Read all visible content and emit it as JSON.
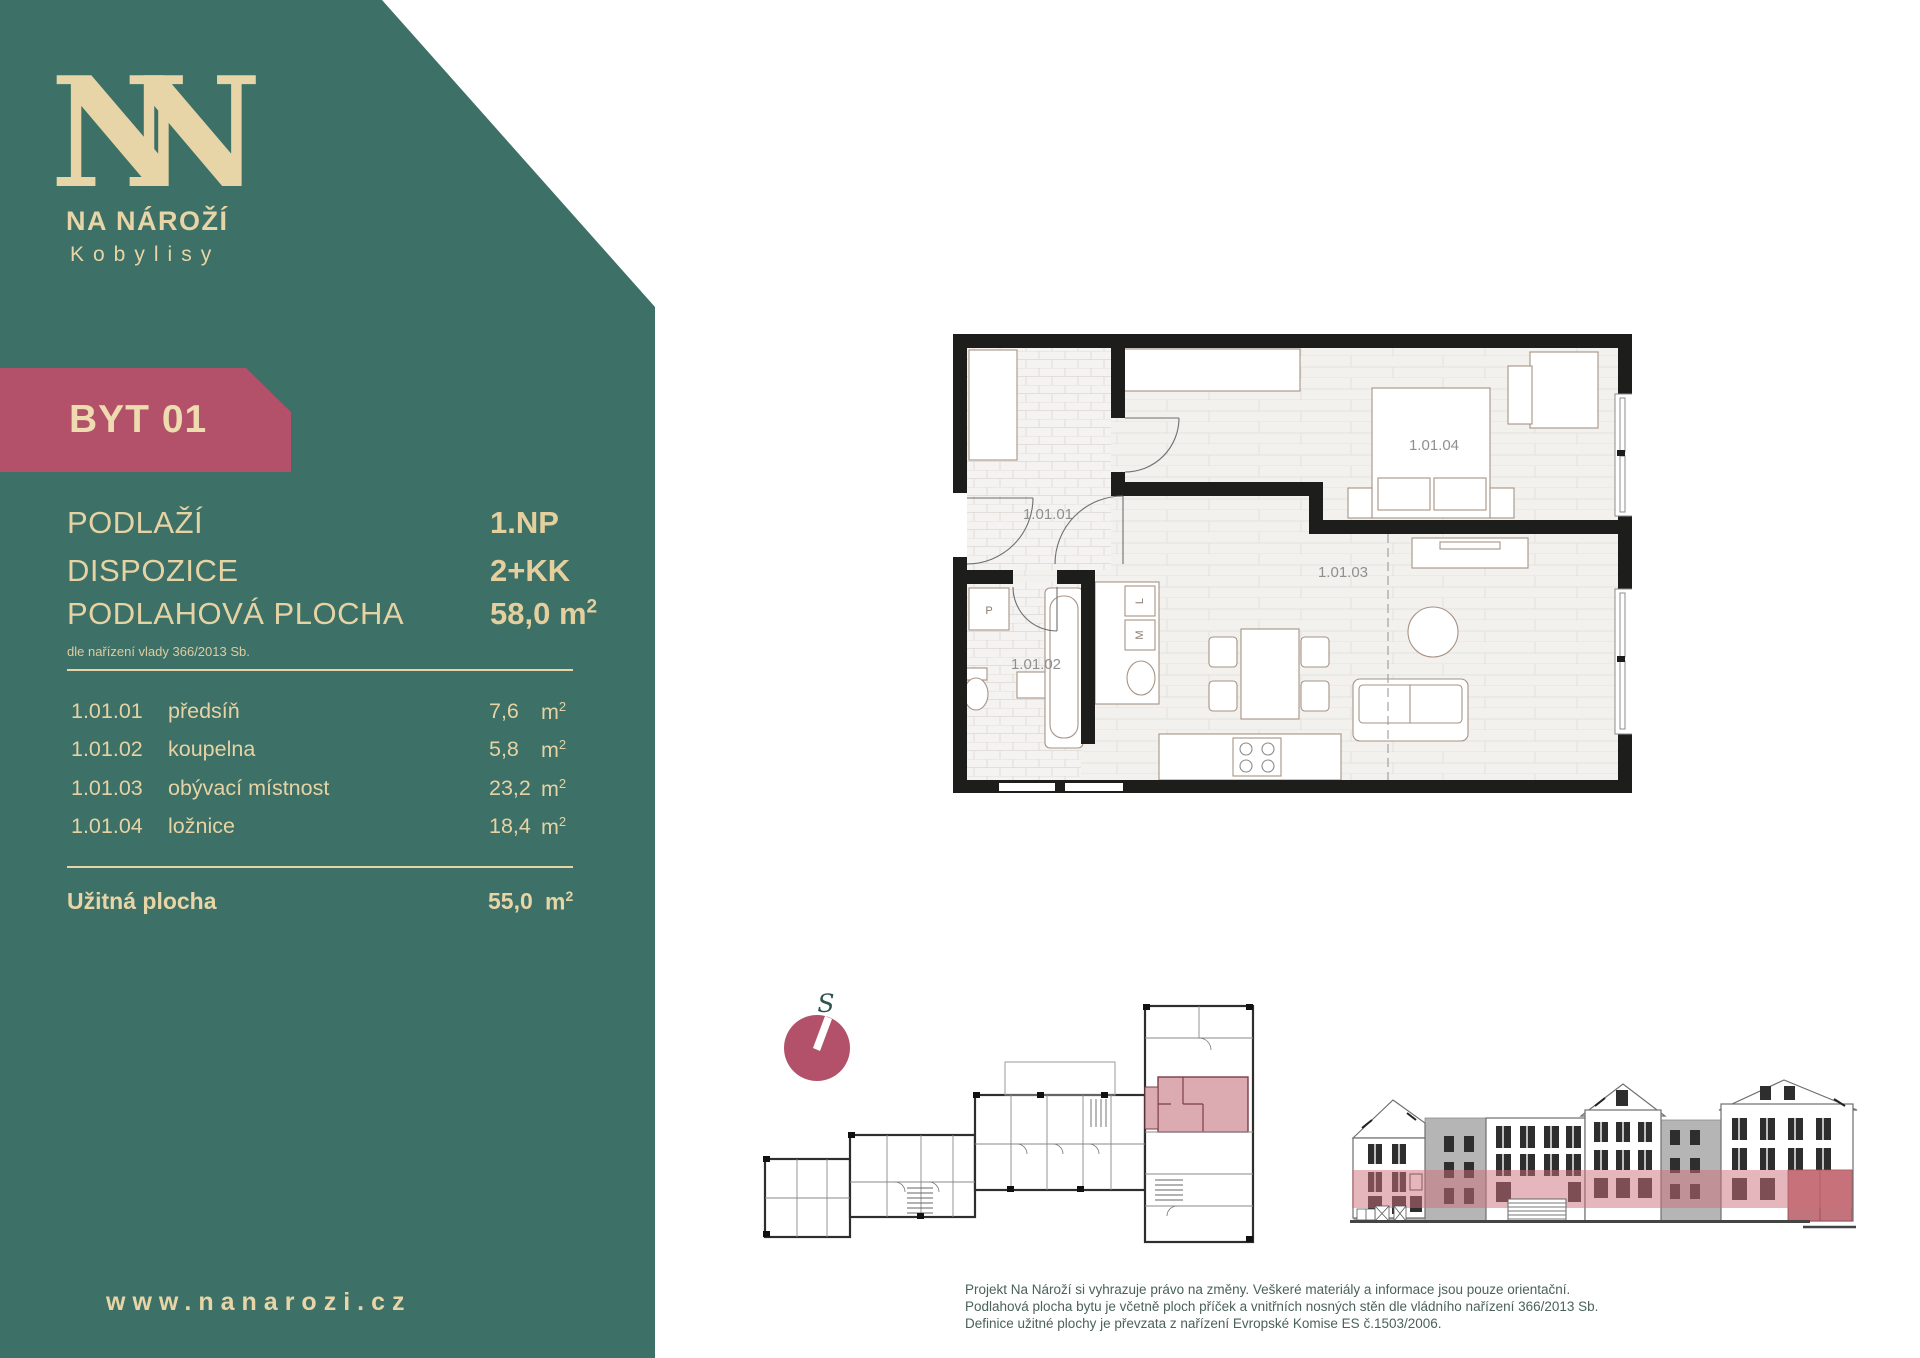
{
  "brand": {
    "monogram": "NN",
    "name": "NA NÁROŽÍ",
    "subtitle": "Kobylisy",
    "website": "www.nanarozi.cz"
  },
  "badge": {
    "label": "BYT 01"
  },
  "summary": {
    "rows": [
      {
        "label": "PODLAŽÍ",
        "value": "1.NP",
        "unit_base": "",
        "unit_sup": ""
      },
      {
        "label": "DISPOZICE",
        "value": "2+KK",
        "unit_base": "",
        "unit_sup": ""
      },
      {
        "label": "PODLAHOVÁ PLOCHA",
        "value": "58,0",
        "unit_base": "m",
        "unit_sup": "2"
      }
    ],
    "note": "dle nařízení vlady 366/2013 Sb."
  },
  "rooms": [
    {
      "code": "1.01.01",
      "name": "předsíň",
      "area": "7,6"
    },
    {
      "code": "1.01.02",
      "name": "koupelna",
      "area": "5,8"
    },
    {
      "code": "1.01.03",
      "name": "obývací místnost",
      "area": "23,2"
    },
    {
      "code": "1.01.04",
      "name": "ložnice",
      "area": "18,4"
    }
  ],
  "units": {
    "base": "m",
    "sup": "2"
  },
  "total": {
    "label": "Užitná plocha",
    "area": "55,0"
  },
  "floorplan": {
    "labels": {
      "hall": "1.01.01",
      "bath": "1.01.02",
      "living": "1.01.03",
      "bedroom": "1.01.04"
    },
    "fixtures": {
      "washer": "P",
      "fridge": "L",
      "dishwasher": "M"
    }
  },
  "compass": {
    "label": "S"
  },
  "disclaimer": {
    "lines": [
      "Projekt Na Nároží si vyhrazuje právo na změny. Veškeré materiály a informace jsou pouze orientační.",
      "Podlahová plocha bytu je včetně ploch příček a vnitřních nosných stěn dle vládního nařízení 366/2013 Sb.",
      "Definice užitné plochy je převzata z nařízení Evropské Komise ES č.1503/2006."
    ]
  },
  "colors": {
    "sidebar_teal": "#3d7066",
    "cream": "#e8d5a7",
    "gold_value": "#e5cf9c",
    "accent_maroon": "#b25169",
    "plan_highlight_pink": "#dbabb1",
    "elevation_band_pink": "#cb6f79"
  }
}
